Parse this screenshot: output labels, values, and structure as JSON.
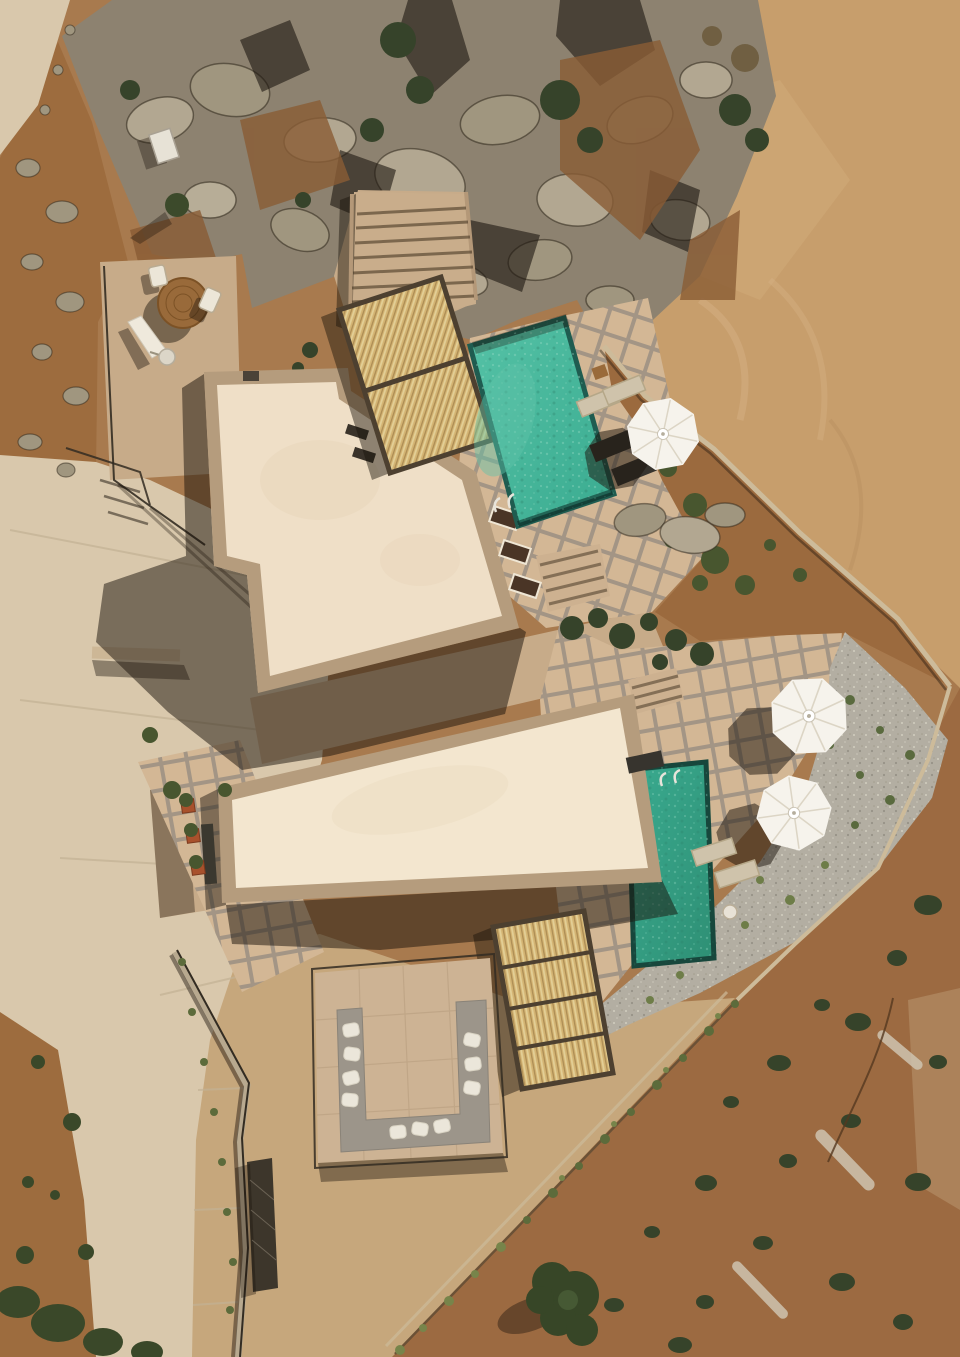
{
  "scene": {
    "type": "aerial-drone-photograph",
    "description": "Top-down aerial view of two modern flat-roofed cream villas built against a rocky limestone hillside, each with a turquoise plunge pool, bamboo pergola roofs, white octagonal patio umbrellas, sun loungers, a sunken outdoor lounge with white cushions, gravel and dirt gardens, stone-tiled terraces and a curving concrete driveway through dry scrubland.",
    "objects": {
      "villas": 2,
      "pools": 2,
      "open_umbrellas": 3,
      "folded_umbrellas": 1,
      "bamboo_pergolas": 2,
      "sun_loungers": 6,
      "round_table": 1,
      "chairs": 2,
      "sofa_cushions": 10,
      "terraces": "stone tiled",
      "terrain": "rock cliff, dirt lot, scrub hillside"
    }
  },
  "colors": {
    "terrain_base": "#a87a4e",
    "dirt_light": "#c79e6c",
    "dirt_red": "#9c6a41",
    "dirt_left": "#9d6c3e",
    "ground_tan": "#c6a77c",
    "concrete": "#d9c8ac",
    "rock_base": "#8d8270",
    "rock_light": "#b2a791",
    "rock_mid": "#a0967f",
    "shrub_green": "#48562f",
    "shrub_dark": "#36432a",
    "terrace_stone": "#c7ab89",
    "tile_paver": "#d3b795",
    "tile_joint": "#a39585",
    "roof_cream": "#efdfc7",
    "roof_cream2": "#f3e6cf",
    "roof_border": "#b59c7d",
    "pool_teal": "#3aab90",
    "pool_teal_light": "#55c2a6",
    "pool_teal_deep": "#2e8f74",
    "pool_rim": "#1f5c50",
    "pool_rim_deep": "#17473c",
    "bamboo": "#d3b372",
    "bamboo_light": "#e3cf96",
    "bamboo_dark": "#aa8a52",
    "bamboo_frame": "#4d4030",
    "umbrella": "#f6f3ec",
    "umbrella_rib": "#dcd5c5",
    "gravel": "#b3aea2",
    "sofa_gray": "#9c958a",
    "cushion_white": "#ebe6da",
    "lounger_dark": "#37342e",
    "lounger_beige": "#cfc3ab",
    "wood": "#996a3a",
    "railing": "#332c22",
    "terracotta": "#a8512c",
    "wall_stone": "#cdbb9a"
  }
}
